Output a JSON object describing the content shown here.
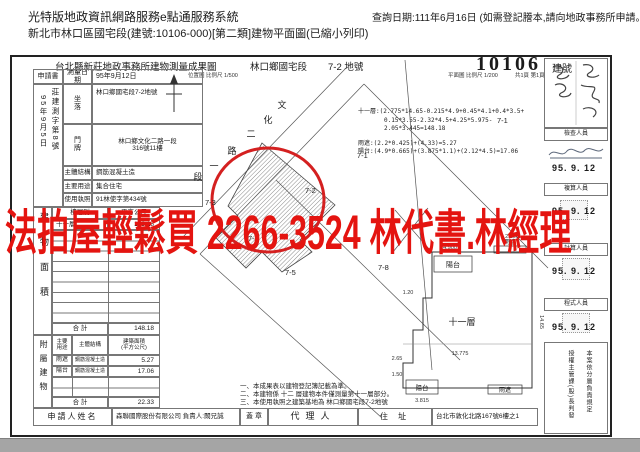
{
  "page": {
    "header": {
      "system_title": "光特版地政資訊網路服務e點通服務系統",
      "doc_subtitle": "新北市林口區國宅段(建號:10106-000)[第二類]建物平面圖(已縮小列印)",
      "query_date": "查詢日期:111年6月16日 (如需登記謄本,請向地政事務所申請。)"
    },
    "banner": {
      "text": "法拍屋輕鬆買 2266-3524 林代書.林經理",
      "color": "#e41410"
    }
  },
  "form": {
    "title": "台北縣新莊地政事務所建物測量成果圖",
    "section_name": "林口鄉國宅段",
    "land_number": "7-2 地號",
    "building_number": "10106",
    "building_number_label": "建號",
    "location_scale": "位置圖 比例尺 1/500",
    "plan_scale": "平面圖 比例尺 1/200",
    "page_count": "共1頁 第1頁",
    "application": {
      "label": "申請書",
      "date_vertical": "95年9月5日",
      "docno_vertical": "莊建測字第8號"
    },
    "info_fields": [
      {
        "label": "測量日期",
        "value": "95年9月12日"
      },
      {
        "label": "坐\n落",
        "value": "林口鄉國宅段7-2地號"
      },
      {
        "label": "門\n牌",
        "value1": "林口鄉文化二路一段",
        "value2": "316號11樓"
      },
      {
        "label": "主體結構",
        "value": "鋼筋混凝土造"
      },
      {
        "label": "主要用途",
        "value": "集合住宅"
      },
      {
        "label": "使用執照",
        "value": "91林使字第434號"
      }
    ],
    "floor_table": {
      "side_label": "建物面積",
      "col_floor": "樓層別",
      "col_area": "平方公尺",
      "row1_floor": "十一層",
      "row1_area": "148.18",
      "total_label": "合  計",
      "total": "148.18"
    },
    "annex_table": {
      "side_label": "附屬建物",
      "col_use": "主要\n用途",
      "col_structure": "主體結構",
      "col_area": "建築面積\n(平方公尺)",
      "row1_use": "雨遮",
      "row1_structure": "鋼筋混凝土造",
      "row1_area": "5.27",
      "row2_use": "陽台",
      "row2_structure": "鋼筋混凝土造",
      "row2_area": "17.06",
      "total_label": "合  計",
      "total": "22.33"
    },
    "notes": [
      "一、本成果表以建物登記簿記載為準。",
      "二、本建物係 十二 層建物本件僅測量第十一層部分。",
      "三、本使用執照之建築基地為 林口鄉國宅段7-2地號"
    ],
    "applicant": {
      "label": "申請人姓名",
      "name": "森聯國際股份有限公司  負責人:闕兄誠",
      "seal_label": "蓋 章",
      "agent_label": "代理人",
      "address_label": "住 址",
      "address": "台北市敦化北路167號6樓之1"
    },
    "calc_lines": [
      "十一層:(2.775*14.65-0.215*4.9+0.45*4.1+0.4*3.5+",
      "0.15*3.55-2.32*4.5+4.25*5.975-2.05*3.445=148.18",
      "雨遮:(2.2*0.425)+(4.33)=5.27",
      "陽台:(4.9*0.665)+(3.875*1.1)+(2.12*4.5)=17.06"
    ],
    "staff_column": {
      "role1": "檢查人員",
      "role2": "複算人員",
      "role3": "計算人員",
      "role4": "程式人員",
      "date1": "95. 9. 12",
      "date2": "95. 9. 12",
      "date3": "95. 9. 12",
      "date4": "95. 9. 12",
      "delegation_right": "本案依分層負責規定",
      "delegation_left": "授權主管課(股)長判發"
    },
    "map": {
      "road_chars": [
        "文",
        "化",
        "二",
        "路",
        "一",
        "段"
      ],
      "parcels": [
        "7-1",
        "7-1",
        "7-2",
        "7-3",
        "7-4",
        "7-5",
        "7-8"
      ],
      "plan": {
        "floor_label": "十一層",
        "balcony_top": "陽台",
        "balcony_bottom": "陽台",
        "canopy_top": "雨遮",
        "canopy_bottom": "雨遮",
        "dims": [
          "4.900",
          "2.200",
          "13.775",
          "3.815",
          "1.20",
          "14.65",
          "2.65",
          "1.50"
        ]
      }
    }
  }
}
